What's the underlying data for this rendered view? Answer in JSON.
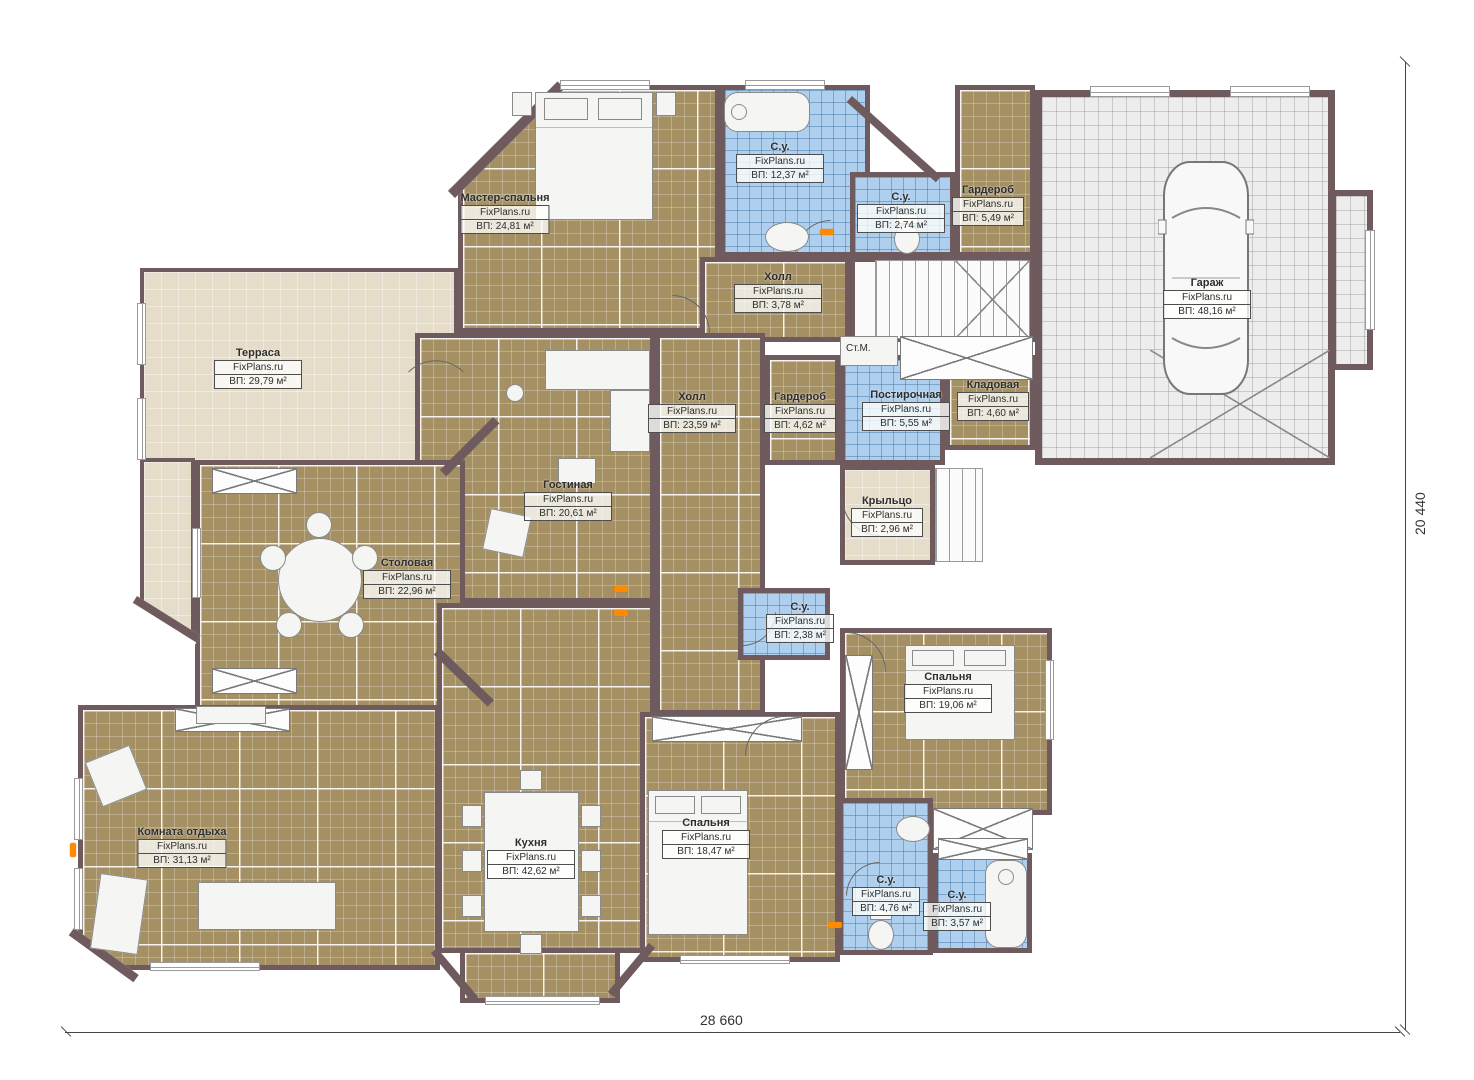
{
  "watermark": "FixPlans.ru",
  "rooms": {
    "master_bedroom": {
      "name": "Мастер-спальня",
      "area": "ВП: 24,81 м²"
    },
    "bath_top": {
      "name": "С.у.",
      "area": "ВП: 12,37 м²"
    },
    "bath_stairs": {
      "name": "С.у.",
      "area": "ВП: 2,74 м²"
    },
    "wardrobe_top": {
      "name": "Гардероб",
      "area": "ВП: 5,49 м²"
    },
    "hall_top": {
      "name": "Холл",
      "area": "ВП: 3,78 м²"
    },
    "garage": {
      "name": "Гараж",
      "area": "ВП: 48,16 м²"
    },
    "terrace": {
      "name": "Терраса",
      "area": "ВП: 29,79 м²"
    },
    "hall_main": {
      "name": "Холл",
      "area": "ВП: 23,59 м²"
    },
    "wardrobe_mid": {
      "name": "Гардероб",
      "area": "ВП: 4,62 м²"
    },
    "laundry": {
      "name": "Постирочная",
      "area": "ВП: 5,55 м²"
    },
    "storage": {
      "name": "Кладовая",
      "area": "ВП: 4,60 м²"
    },
    "porch": {
      "name": "Крыльцо",
      "area": "ВП: 2,96 м²"
    },
    "living": {
      "name": "Гостиная",
      "area": "ВП: 20,61 м²"
    },
    "dining": {
      "name": "Столовая",
      "area": "ВП: 22,96 м²"
    },
    "bath_mid": {
      "name": "С.у.",
      "area": "ВП: 2,38 м²"
    },
    "bedroom_right": {
      "name": "Спальня",
      "area": "ВП: 19,06 м²"
    },
    "bedroom_bottom": {
      "name": "Спальня",
      "area": "ВП: 18,47 м²"
    },
    "lounge": {
      "name": "Комната отдыха",
      "area": "ВП: 31,13 м²"
    },
    "kitchen": {
      "name": "Кухня",
      "area": "ВП: 42,62 м²"
    },
    "bath_br1": {
      "name": "С.у.",
      "area": "ВП: 4,76 м²"
    },
    "bath_br2": {
      "name": "С.у.",
      "area": "ВП: 3,57 м²"
    }
  },
  "annotations": {
    "washing_machine": "Ст.М."
  },
  "dimensions": {
    "width": "28 660",
    "height": "20 440"
  },
  "colors": {
    "wall": "#6f5b5e",
    "floor_tile_brown": "#a59064",
    "floor_tile_blue": "#aecfee",
    "floor_terrace_beige": "#e5dcc9",
    "floor_garage_gray": "#ededed",
    "marker_orange": "#ff8a00"
  }
}
